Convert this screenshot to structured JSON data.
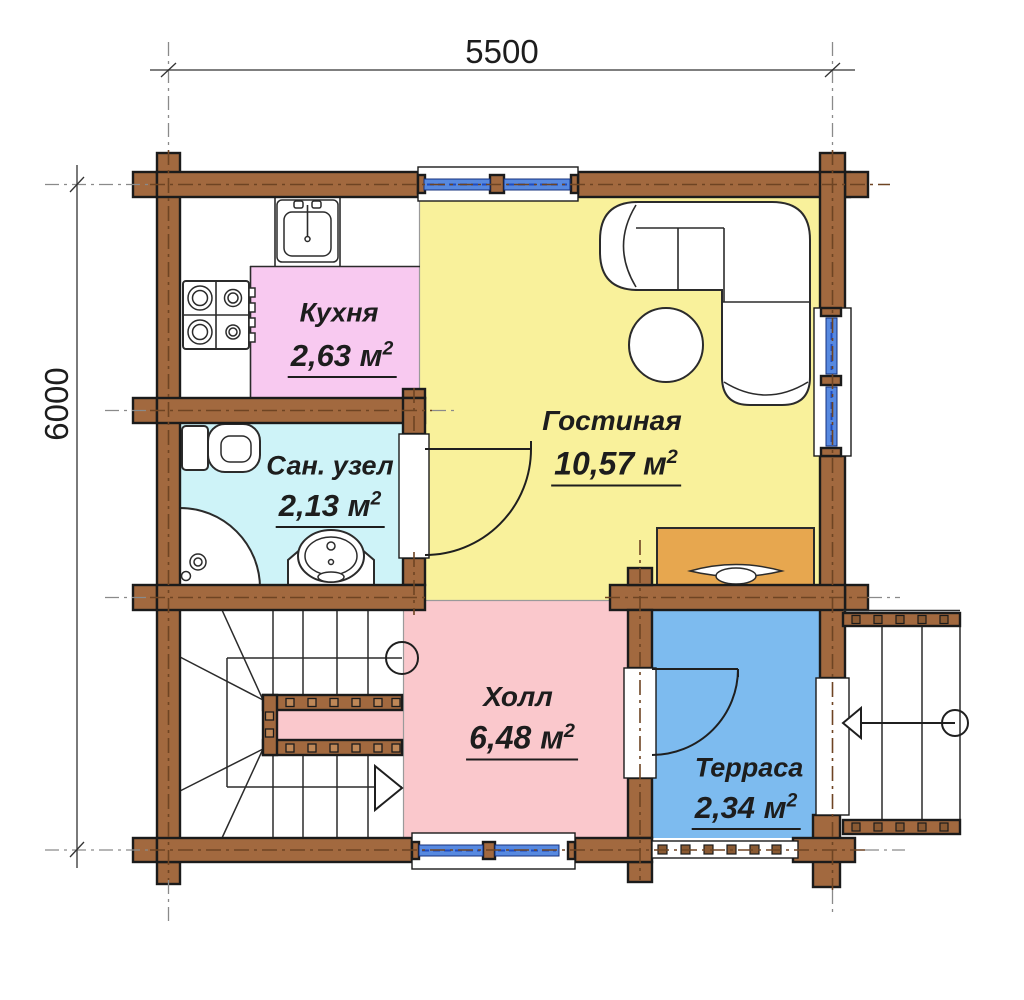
{
  "dimensions": {
    "width_label": "5500",
    "height_label": "6000"
  },
  "rooms": [
    {
      "id": "kitchen",
      "label": "Кухня",
      "area": "2,63 м",
      "exp": "2",
      "color": "#F8C9F0"
    },
    {
      "id": "bathroom",
      "label": "Сан. узел",
      "area": "2,13 м",
      "exp": "2",
      "color": "#CEF3F8"
    },
    {
      "id": "living",
      "label": "Гостиная",
      "area": "10,57 м",
      "exp": "2",
      "color": "#F9F19B"
    },
    {
      "id": "hall",
      "label": "Холл",
      "area": "6,48 м",
      "exp": "2",
      "color": "#FAC8CC"
    },
    {
      "id": "terrace",
      "label": "Терраса",
      "area": "2,34 м",
      "exp": "2",
      "color": "#7DBBEF"
    }
  ],
  "colors": {
    "wall": "#A2693F",
    "kitchen": "#F8C9F0",
    "bathroom": "#CEF3F8",
    "living": "#F9F19B",
    "hall": "#FAC8CC",
    "terrace": "#7DBBEF",
    "table": "#E7A74F",
    "window": "#5789E0"
  },
  "furniture": [
    "corner-sofa",
    "round-table",
    "console-table",
    "kitchen-sink",
    "stove",
    "toilet",
    "corner-shower",
    "washbasin",
    "stairs",
    "entry-steps"
  ]
}
